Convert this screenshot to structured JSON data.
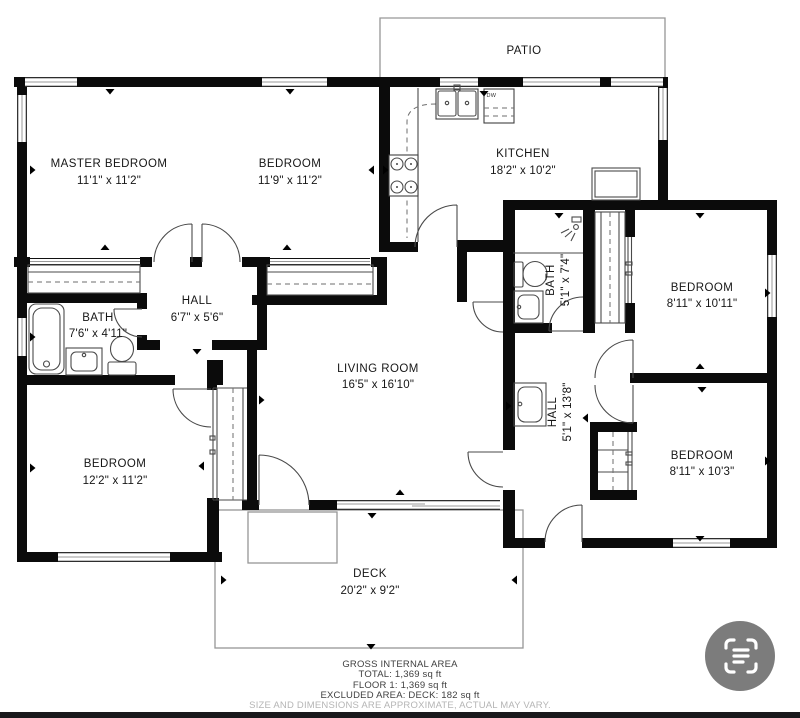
{
  "plan": {
    "outdoor": {
      "patio": {
        "name": "PATIO"
      },
      "deck": {
        "name": "DECK",
        "dims": "20'2\" x 9'2\""
      }
    },
    "rooms": {
      "master_bedroom": {
        "name": "MASTER BEDROOM",
        "dims": "11'1\" x 11'2\""
      },
      "bedroom_top": {
        "name": "BEDROOM",
        "dims": "11'9\" x 11'2\""
      },
      "kitchen": {
        "name": "KITCHEN",
        "dims": "18'2\" x 10'2\""
      },
      "bedroom_ne": {
        "name": "BEDROOM",
        "dims": "8'11\" x 10'11\""
      },
      "bedroom_se": {
        "name": "BEDROOM",
        "dims": "8'11\" x 10'3\""
      },
      "bedroom_sw": {
        "name": "BEDROOM",
        "dims": "12'2\" x 11'2\""
      },
      "living_room": {
        "name": "LIVING ROOM",
        "dims": "16'5\" x 16'10\""
      },
      "hall_center": {
        "name": "HALL",
        "dims": "6'7\" x 5'6\""
      },
      "hall_east": {
        "name": "HALL",
        "dims": "5'1\" x 13'8\""
      },
      "bath_main": {
        "name": "BATH",
        "dims": "7'6\" x 4'11\""
      },
      "bath_east": {
        "name": "BATH",
        "dims": "5'1\" x 7'4\""
      }
    },
    "appliance_labels": {
      "dishwasher": "DW"
    },
    "footer": {
      "title": "GROSS INTERNAL AREA",
      "total": "TOTAL: 1,369 sq ft",
      "floor1": "FLOOR 1: 1,369 sq ft",
      "excluded": "EXCLUDED AREA: DECK: 182 sq ft",
      "disclaimer": "SIZE AND DIMENSIONS ARE APPROXIMATE, ACTUAL MAY VARY."
    },
    "colors": {
      "wall": "#0b0b0b",
      "background": "#ffffff",
      "thin_line": "#4a4a4a",
      "outdoor_line": "#969696",
      "footer_text": "#3f3f3f",
      "disclaimer_text": "#b5b5b5",
      "scan_button": "#7c7c7c",
      "bottom_bar": "#19191b"
    }
  },
  "controls": {
    "scan_button": {
      "icon": "scan-text-icon"
    }
  }
}
